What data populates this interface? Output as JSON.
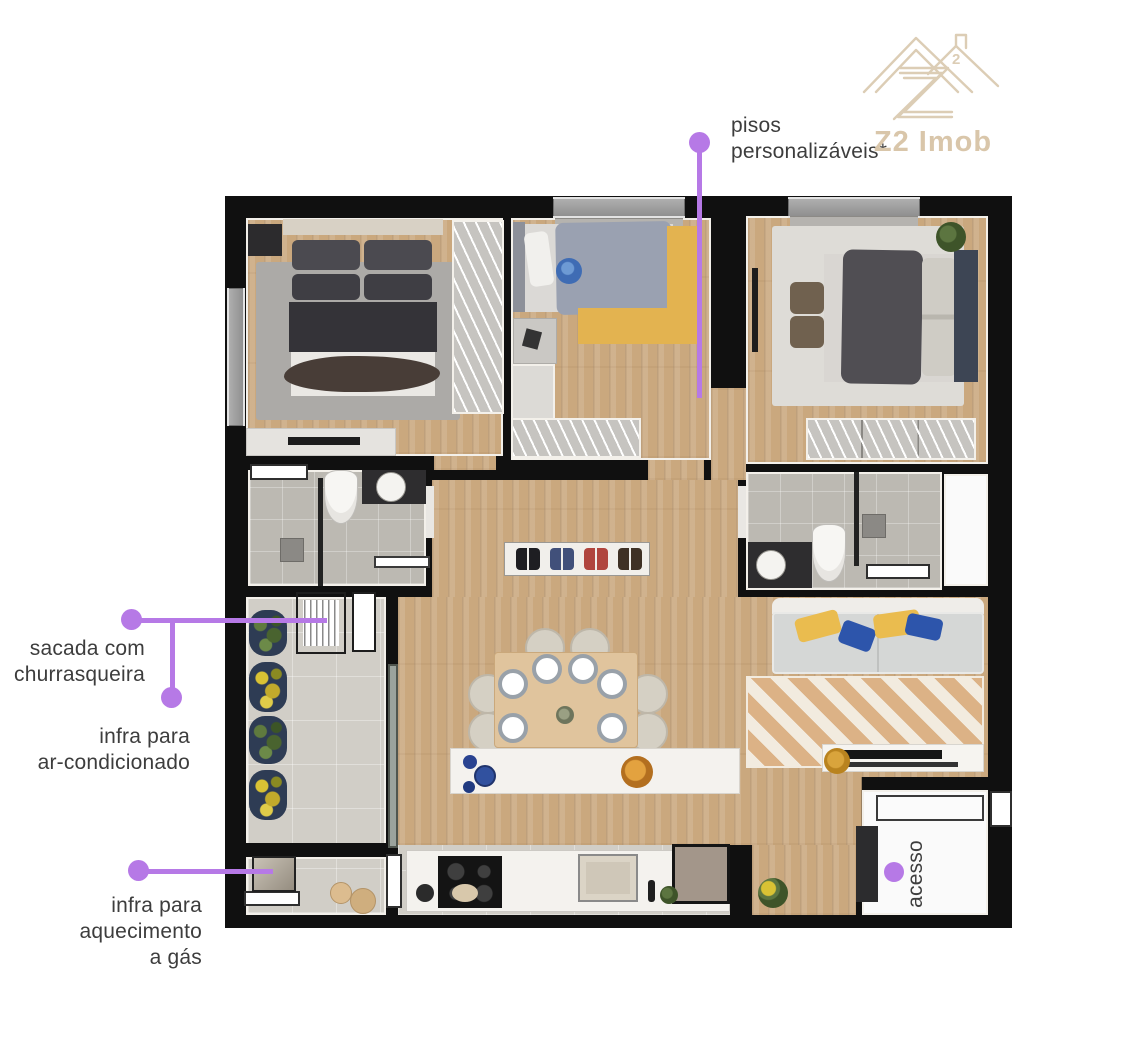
{
  "logo": {
    "brand": "Z2 Imob",
    "sup": "2",
    "color": "#d9c6aa"
  },
  "annotations": {
    "accent_color": "#b679e6",
    "text_color": "#3d3d3d",
    "pisos": {
      "lines": [
        "pisos",
        "personalizáveis*"
      ]
    },
    "sacada": {
      "lines": [
        "sacada com",
        "churrasqueira"
      ]
    },
    "ar_condicionado": {
      "lines": [
        "infra para",
        "ar-condicionado"
      ]
    },
    "aquecimento": {
      "lines": [
        "infra para",
        "aquecimento",
        "a gás"
      ]
    },
    "acesso": {
      "label": "acesso"
    }
  },
  "palette": {
    "wall": "#101010",
    "wood_floor": "#caa87e",
    "bath_tile": "#bcb9b2",
    "balcony_tile": "#d1cec7"
  }
}
